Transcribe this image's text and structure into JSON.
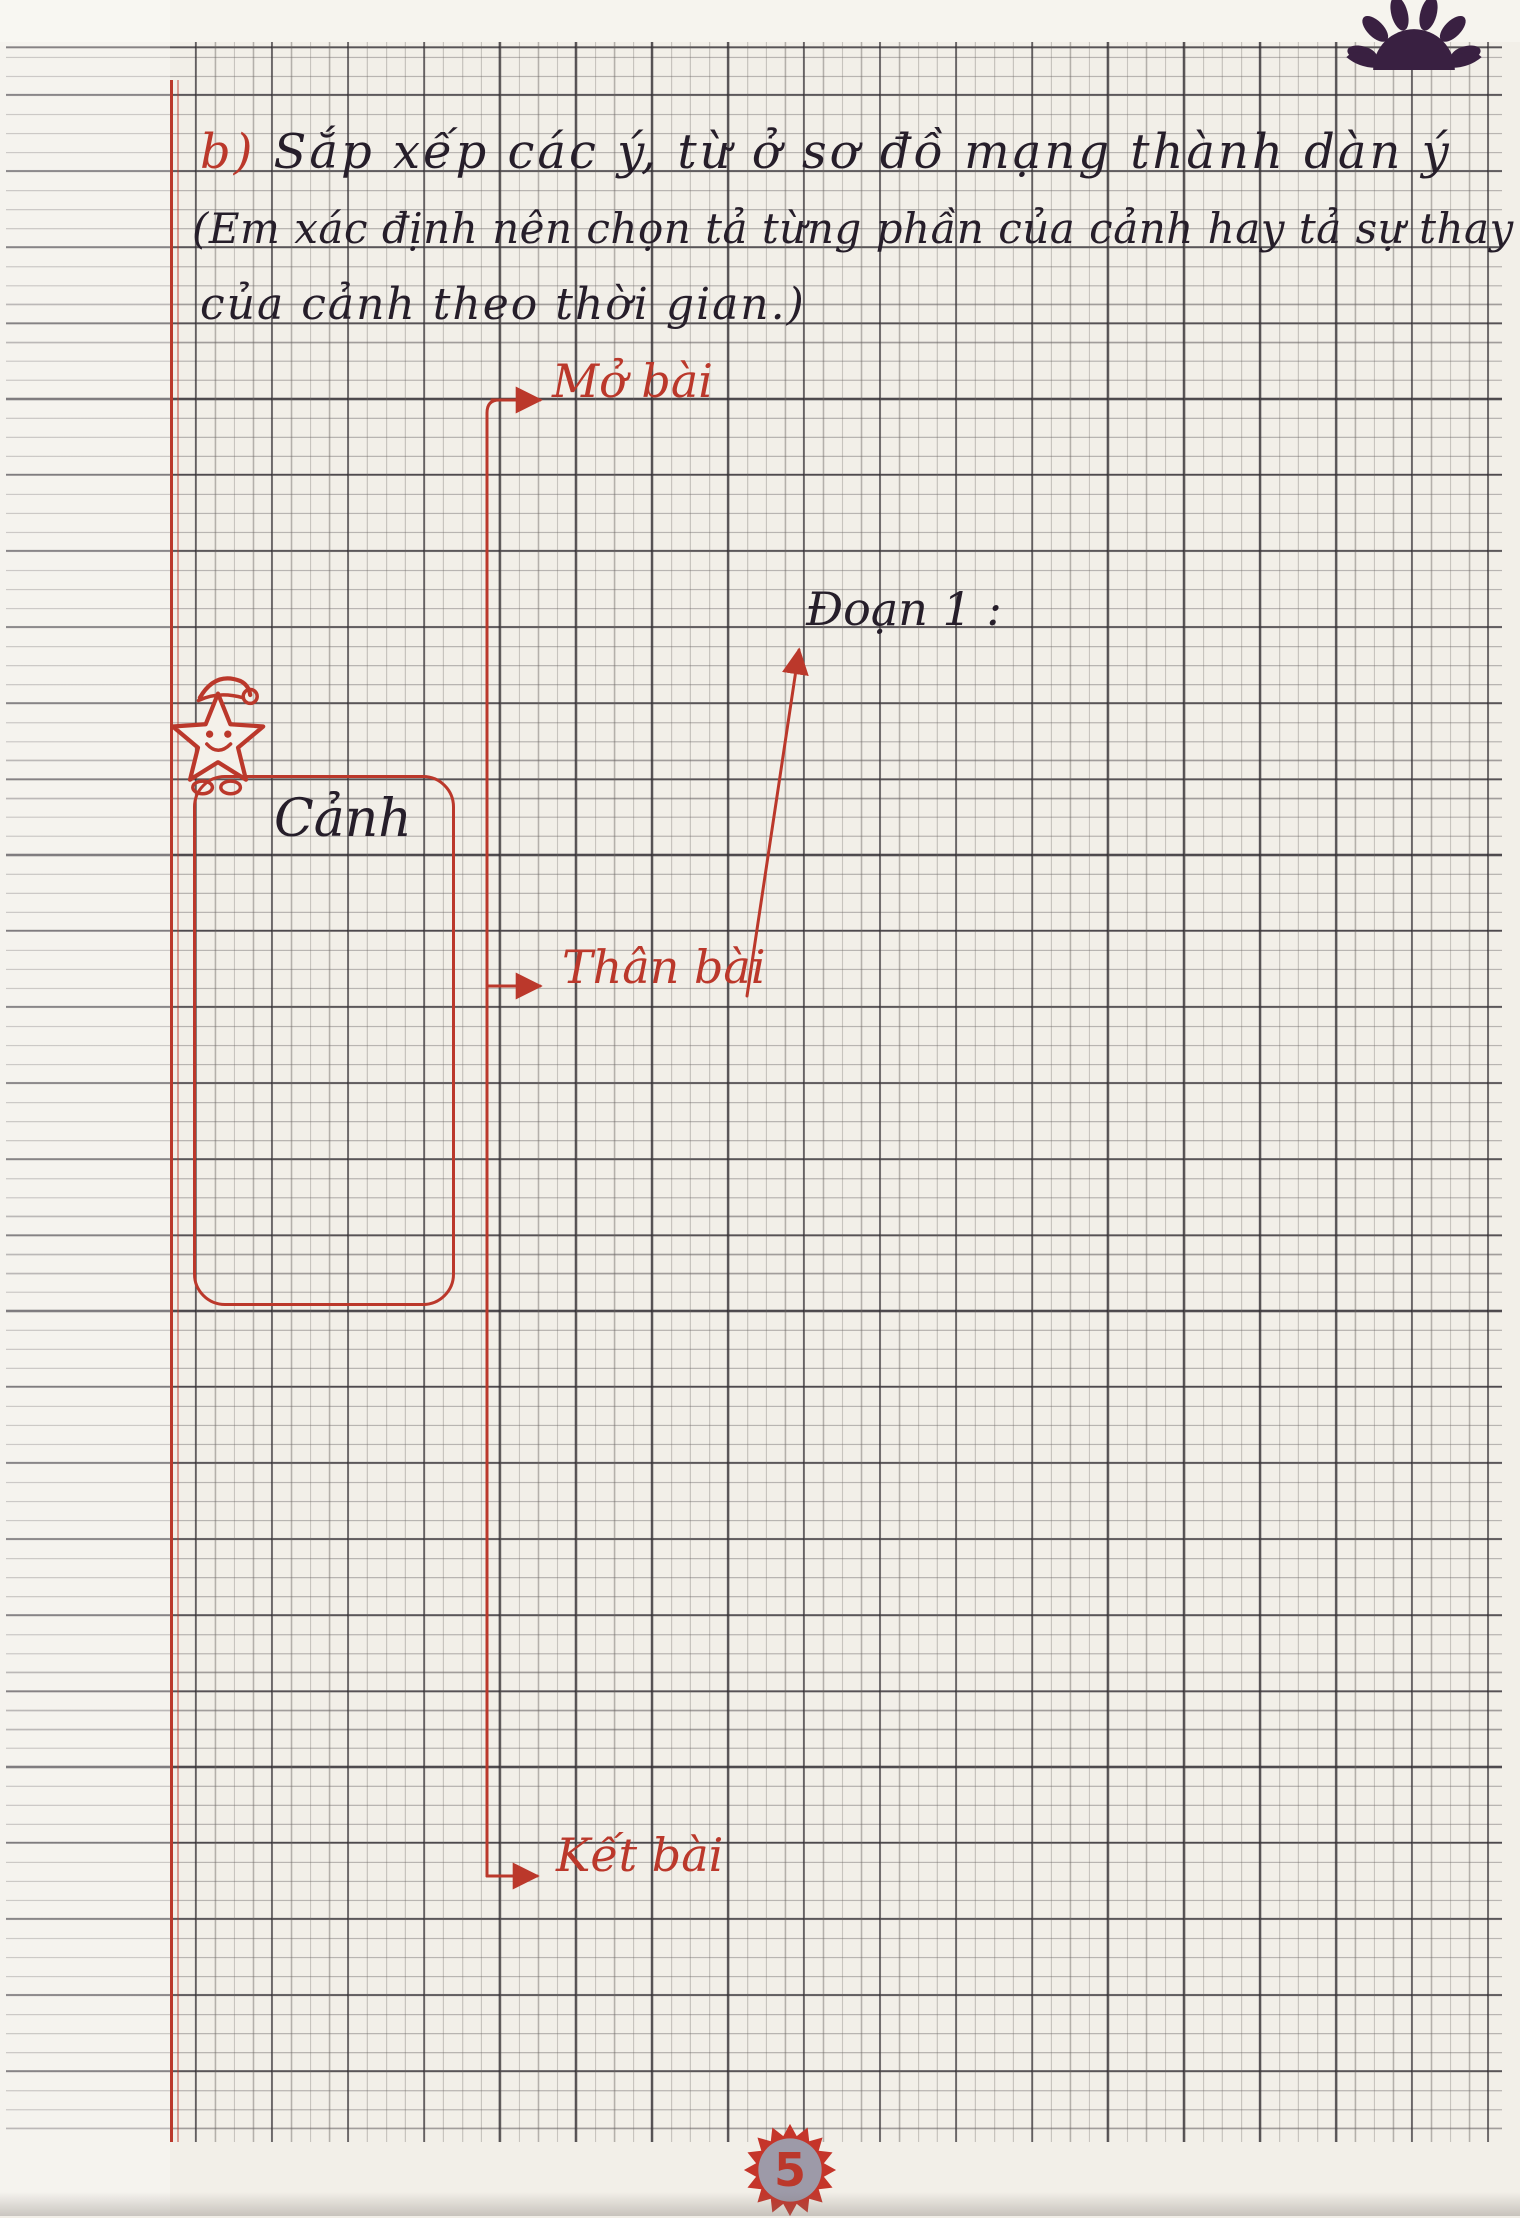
{
  "page": {
    "page_number": "5",
    "colors": {
      "paper": "#f2efe8",
      "ink_black": "#261e2a",
      "ink_red": "#bb382b",
      "grid_heavy": "#2c2830",
      "logo_purple": "#392041",
      "badge_circle": "#9d9aa8"
    }
  },
  "exercise": {
    "marker": "b)",
    "line1": "Sắp xếp các ý, từ ở sơ đồ mạng thành dàn ý",
    "line2": "(Em xác định nên chọn tả từng phần của cảnh hay tả sự thay đổi",
    "line3": "của cảnh theo thời gian.)"
  },
  "diagram": {
    "box_label": "Cảnh",
    "node_opening": "Mở bài",
    "node_body": "Thân bài",
    "node_closing": "Kết bài",
    "annotation_paragraph1": "Đoạn 1 :"
  }
}
